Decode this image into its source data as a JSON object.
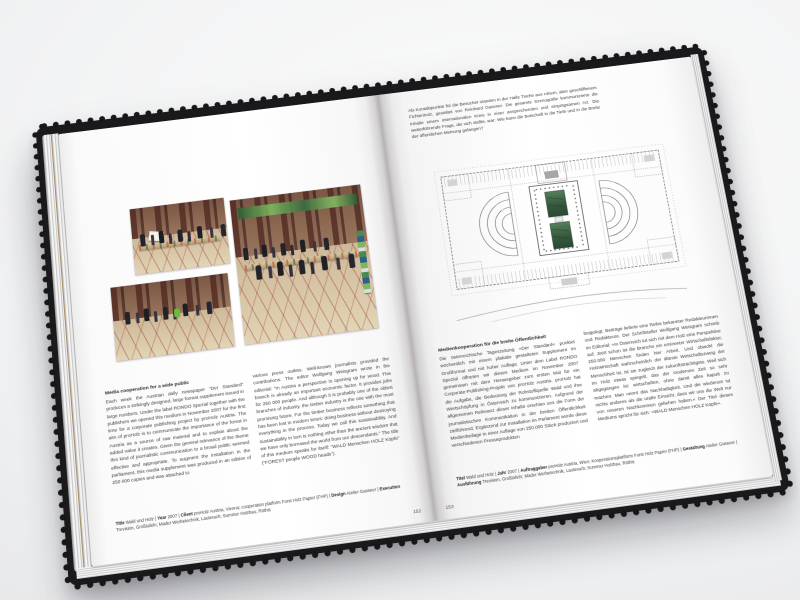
{
  "book": {
    "description": "Open design monograph spread (Atelier Gassner) documenting the proHolz Austria project »Wald und Holz« in the Austrian Parliament",
    "colors": {
      "cover": "#1a1a1c",
      "paper": "#ffffff",
      "plan_lines": "#6d6d6d",
      "installation_green": "#3e6547",
      "photo_marble": "#6d4a3c",
      "photo_floor": "#d9c9ab"
    },
    "left_page": {
      "page_number": "152",
      "photos": [
        {
          "name": "photo-visitors-reading",
          "desc": "Visitors reading the large-format supplement in the columned hall of the parliament"
        },
        {
          "name": "photo-hall-overview",
          "desc": "Columned hall of the Austrian Parliament with wooden tables, green banner and visitors"
        },
        {
          "name": "photo-visitor-group",
          "desc": "Group of visitors standing on the ornamented marble floor between columns"
        }
      ],
      "heading": "Media cooperation for a wide public",
      "body_col1": "Each week the Austrian daily newspaper “Der Standard” produces a strikingly designed, large format supplement issued in large numbers. Under the label RONDO Spezial together with the publishers we opened this medium in November 2007 for the first time for a corporate publishing project by proHolz Austria. The aim of proHolz is to communicate the importance of the forest in Austria as a source of raw material and to explain about the added value it creates. Given the general relevance of the theme this kind of journalistic communication to a broad public seemed effective and appropriate. To augment the installation in the parliament, this media supplement was produced in an edition of 250 000 copies and was attached to",
      "body_col2": "various press outlets. Well-known journalists provided the contributions. The editor Wolfgang Weisgram wrote in the editorial: “In Austria a perspective is opening up for wood. This branch is already an important economic factor. It provides jobs for 250 000 people. And although it is probably one of the oldest branches of industry, the timber industry is the one with the most promising future. For the timber business reflects something that has been lost in modern times: doing business without destroying everything in the process. Today we call this sustainability. And sustainability in turn is nothing other than the ancient wisdom that we have only borrowed the world from our descendants.” The title of this medium speaks for itself: “WALD Menschen HOLZ Köpfe” (“FOREST people WOOD heads”).",
      "caption_segments": [
        {
          "b": "Title",
          "t": " Wald und Holz | "
        },
        {
          "b": "Year",
          "t": " 2007 | "
        },
        {
          "b": "Client",
          "t": " proHolz Austria, Vienna; cooperation platform Forst Holz Papier (FHP) | "
        },
        {
          "b": "Design",
          "t": " Atelier Gassner | "
        },
        {
          "b": "Execution",
          "t": " Trevision, Großtafeln; Mader Werbetechnik, Lauterach; Summer Holzbau, Röthis"
        }
      ]
    },
    "right_page": {
      "page_number": "153",
      "intro": "Als Kontaktpunkte für die Besucher standen in der Halle Tische aus rohem, aber geschliffenem Fichtenholz, gestaltet von Reinhard Gassner. Die gesamte Szenografie kommunizierte die Inhalte einem internationalen Kreis in einer ansprechenden und einprägsamen Art. Die weiterführende Frage, die sich stellte, war: Wie kann die Botschaft in die Tiefe und in die Breite der öffentlichen Meinung gelangen?",
      "plan": {
        "name": "parliament-floor-plan",
        "desc": "Ground plan of the Austrian Parliament in Vienna with the two semicircular assembly halls and the green wood installation in the central columned hall"
      },
      "heading": "Medienkooperation für die breite Öffentlichkeit",
      "body_col1": "Die österreichische Tageszeitung »Der Standard« punktet wöchentlich mit einem plakativ gestalteten Supplement im Großformat und mit hoher Auflage. Unter dem Label RONDO Spezial öffneten wir dieses Medium im November 2007 gemeinsam mit dem Herausgeber zum ersten Mal für ein Corporate-Publishing-Projekt von proHolz Austria. proHolz hat die Aufgabe, die Bedeutung der Rohstoffquelle Wald und ihre Wertschöpfung in Österreich zu kommunizieren. Aufgrund der allgemeinen Relevanz dieser Inhalte erschien uns die Form der journalistischen Kommunikation in der breiten Öffentlichkeit zielführend. Ergänzend zur Installation im Parlament wurde diese Medienbeilage in einer Auflage von 250.000 Stück produziert und verschiedenen Presseprodukten",
      "body_col2": "beigelegt. Beiträge lieferte eine Reihe bekannter Redakteurinnen und Redakteure. Der Schriftsteller Wolfgang Weisgram schrieb im Editorial: »In Österreich tut sich mit dem Holz eine Perspektive auf. Jetzt schon ist die Branche ein eminenter Wirtschaftsfaktor, 250.000 Menschen finden hier Arbeit. Und obwohl die Holzwirtschaft wahrscheinlich der älteste Wirtschaftszweig der Menschheit ist, ist sie zugleich der zukunftsträchtigste. Weil sich im Holz etwas spiegelt, das der modernen Zeit so sehr abgegangen ist: wirtschaften, ohne damit alles kaputt zu machen. Man nennt das Nachhaltigkeit. Und die wiederum ist nichts anderes als die uralte Einsicht, dass wir uns die Welt nur von unseren Nachkommen geliehen haben.« Der Titel dieses Mediums spricht für sich: »WALD Menschen HOLZ Köpfe«.",
      "caption_segments": [
        {
          "b": "Titel",
          "t": " Wald und Holz | "
        },
        {
          "b": "Jahr",
          "t": " 2007 | "
        },
        {
          "b": "Auftraggeber",
          "t": " proHolz Austria, Wien; Kooperationsplattform Forst Holz Papier (FHP) | "
        },
        {
          "b": "Gestaltung",
          "t": " Atelier Gassner | "
        },
        {
          "b": "Ausführung",
          "t": " Trevision, Großtafeln; Mader Werbetechnik, Lauterach; Summer Holzbau, Röthis"
        }
      ]
    }
  }
}
